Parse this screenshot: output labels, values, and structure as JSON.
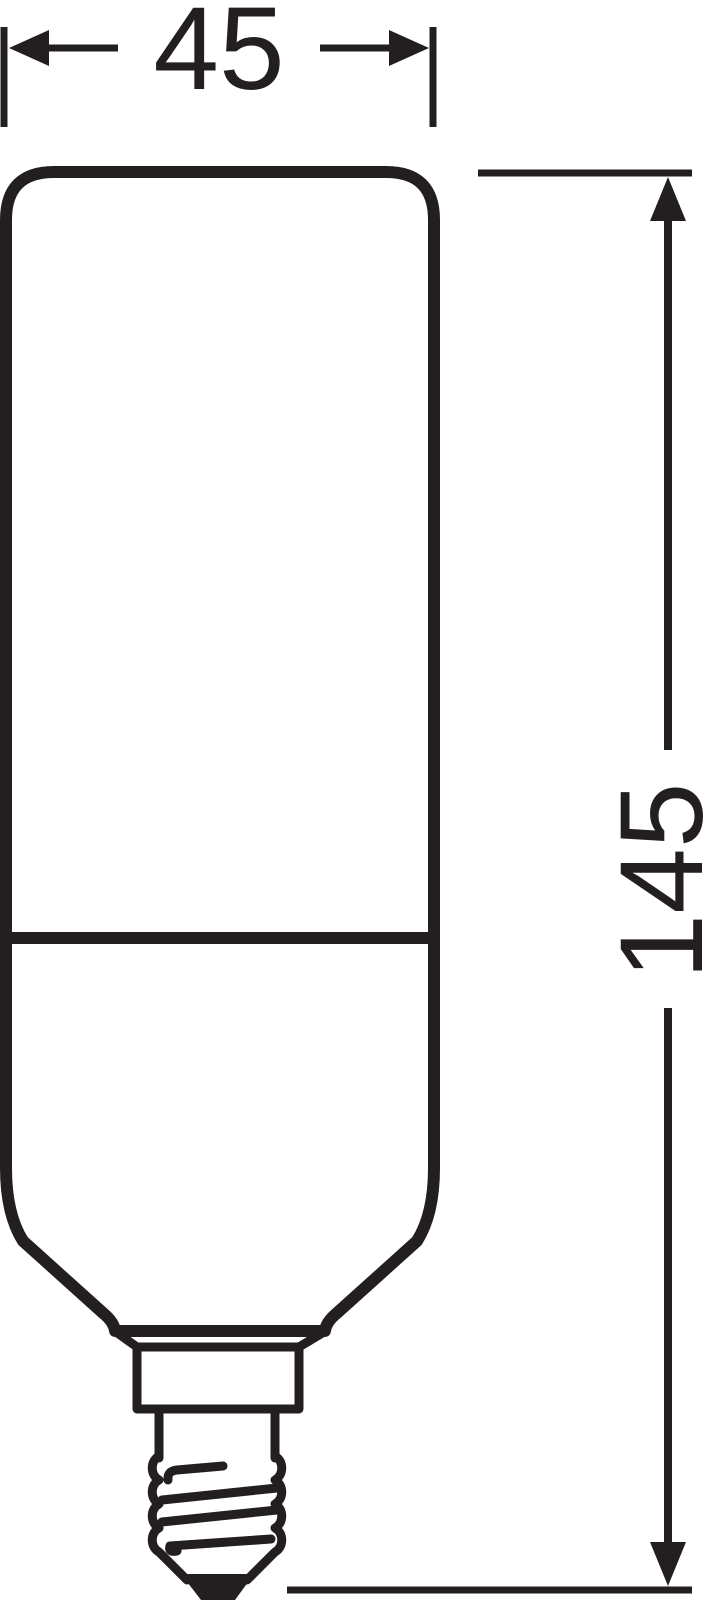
{
  "diagram": {
    "subject": "tubular-lamp-with-screw-base-dimension-drawing",
    "background_color": "#ffffff",
    "line_color": "#231f20",
    "width_dimension": {
      "label": "45"
    },
    "height_dimension": {
      "label": "145"
    }
  }
}
